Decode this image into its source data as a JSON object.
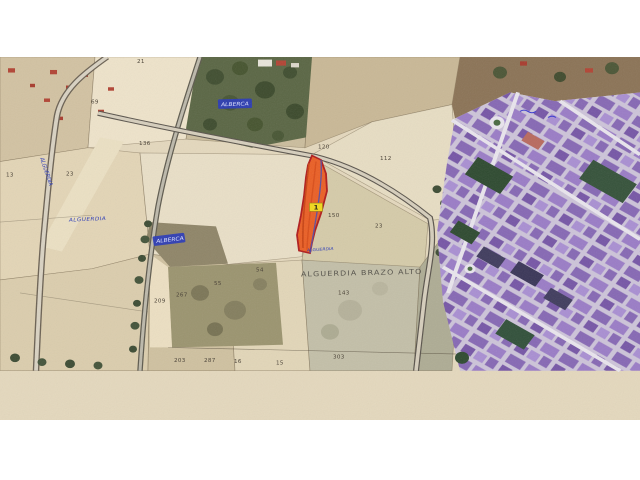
{
  "page": {
    "background_color": "#ffffff"
  },
  "map": {
    "type": "aerial-cadastral-photo",
    "region_label": "ALGUERDIA BRAZO ALTO",
    "highlighted_parcel": {
      "tag": "1",
      "fill_color": "#ea5f25",
      "outline_color": "#b01c1c",
      "east_edge_color": "#5d4f9e",
      "tag_background": "#f2d91c"
    },
    "ink_labels": {
      "ink_color": "#2a3ab8",
      "patch_top_text": "ALBERCA",
      "patch_mid_text": "ALBERCA",
      "field_text": "ALGUERDIA",
      "diagonal_text": "ALGUERDIA",
      "below_parcel_text": "ALGUERDIA"
    },
    "parcel_numbers": [
      {
        "text": "21"
      },
      {
        "text": "69"
      },
      {
        "text": "136"
      },
      {
        "text": "13"
      },
      {
        "text": "23"
      },
      {
        "text": "120"
      },
      {
        "text": "112"
      },
      {
        "text": "150"
      },
      {
        "text": "23"
      },
      {
        "text": "54"
      },
      {
        "text": "55"
      },
      {
        "text": "267"
      },
      {
        "text": "209"
      },
      {
        "text": "143"
      },
      {
        "text": "203"
      },
      {
        "text": "287"
      },
      {
        "text": "16"
      },
      {
        "text": "15"
      },
      {
        "text": "303"
      }
    ]
  }
}
